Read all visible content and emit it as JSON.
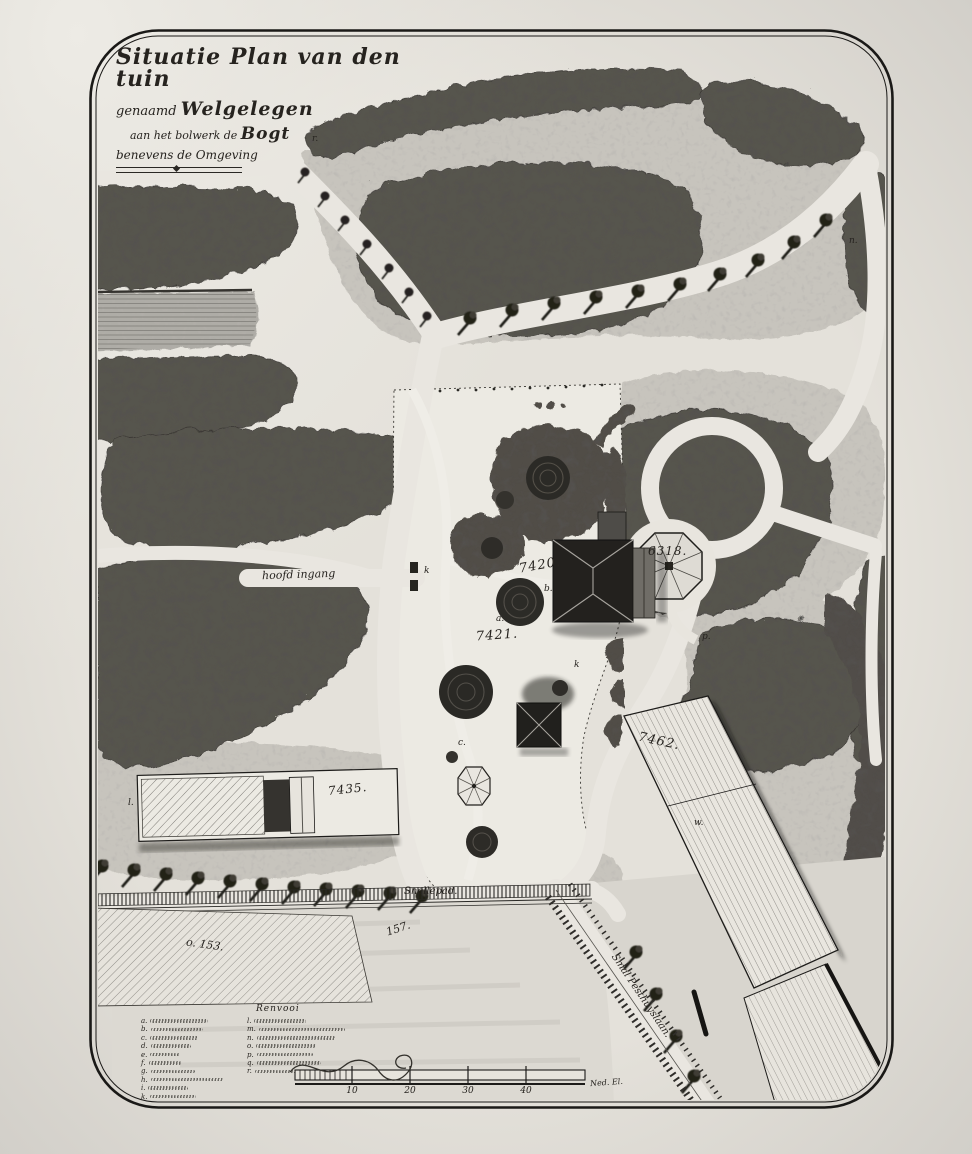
{
  "title": {
    "line1": "Situatie Plan van den tuin",
    "line2_prefix": "genaamd",
    "line2_name": "Welgelegen",
    "line3_prefix": "aan het bolwerk de",
    "line3_name": "Bogt",
    "line4": "benevens de Omgeving"
  },
  "labels": {
    "main_entrance": "hoofd ingang",
    "path_snellepad": "Snellepad.",
    "road_diagonal": "Smal Pesthuyslaan.",
    "plots": {
      "p7420": "7420.",
      "p7421": "7421.",
      "p6318": "6318.",
      "p7435": "7435.",
      "p7462": "7462.",
      "p153": "o. 153.",
      "p157": "157."
    },
    "letters": {
      "a": "a.",
      "b": "b.",
      "c": "c.",
      "k": "k",
      "k2": "k",
      "l": "l.",
      "n_meadow": "n.",
      "n_pavilion": "n.",
      "p": "p.",
      "r": "r.",
      "w": "w."
    }
  },
  "legend": {
    "heading": "Renvooi",
    "column1": [
      {
        "letter": "a."
      },
      {
        "letter": "b."
      },
      {
        "letter": "c."
      },
      {
        "letter": "d."
      },
      {
        "letter": "e."
      },
      {
        "letter": "f."
      },
      {
        "letter": "g."
      },
      {
        "letter": "h."
      },
      {
        "letter": "i."
      },
      {
        "letter": "k."
      }
    ],
    "column2": [
      {
        "letter": "l."
      },
      {
        "letter": "m."
      },
      {
        "letter": "n."
      },
      {
        "letter": "o."
      },
      {
        "letter": "p."
      },
      {
        "letter": "q."
      },
      {
        "letter": "r."
      }
    ]
  },
  "scale": {
    "ticks": [
      "10",
      "20",
      "30",
      "40"
    ],
    "unit": "Ned. El."
  },
  "colors": {
    "paper": "#e4e1da",
    "ink": "#26231f",
    "foliage": "#57544d",
    "meadow": "#c7c4bd",
    "water": "#aeaca6"
  }
}
